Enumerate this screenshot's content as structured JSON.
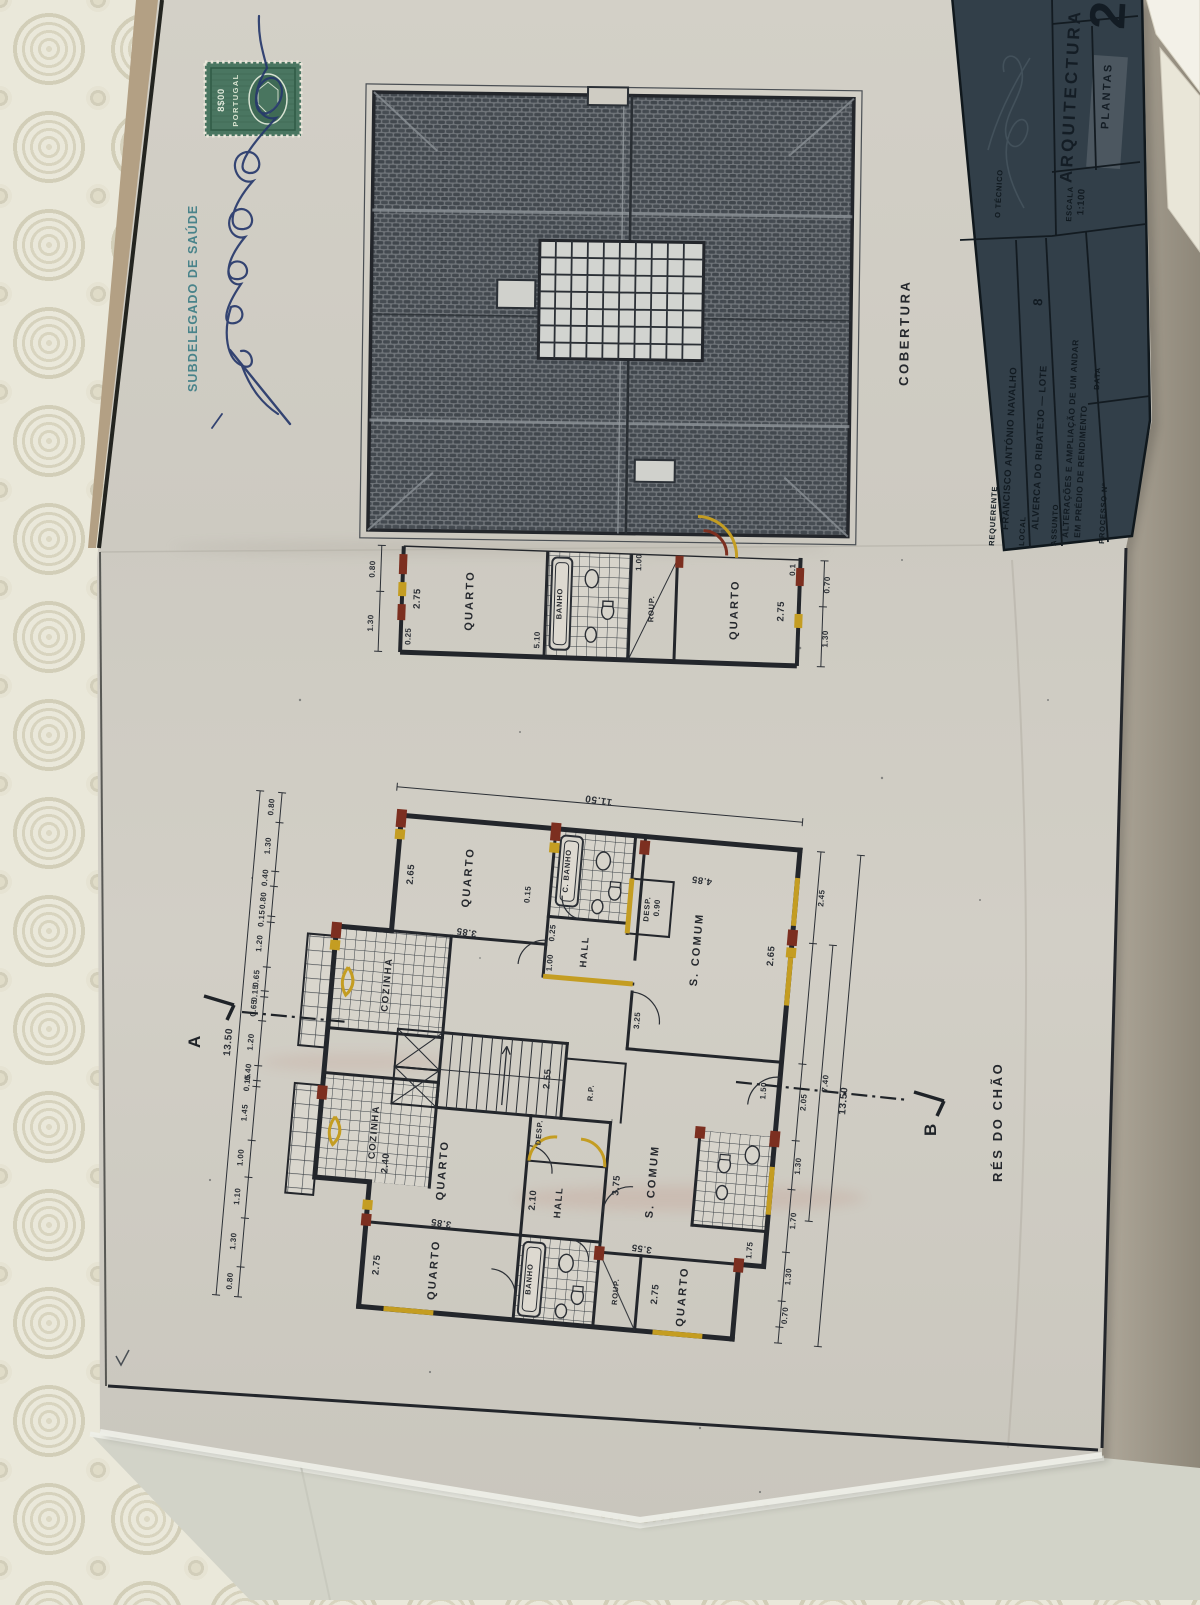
{
  "colors": {
    "drawing_ink": "#24272c",
    "alteration_yellow": "#c49d22",
    "alteration_red": "#7c2f20",
    "stamp_green": "#4a7661",
    "authority_teal": "#3e7d86",
    "signature_ink": "#26386b",
    "titleblock_bg": "#323f49"
  },
  "stamp_area": {
    "authority_text": "SUBDELEGADO DE SAÚDE",
    "stamp_value": "8$00",
    "stamp_country": "PORTUGAL"
  },
  "titleblock": {
    "sheet_number": "2",
    "discipline": "ARQUITECTURA",
    "content_type": "PLANTAS",
    "tecnico_label": "O TÉCNICO",
    "escala_label": "ESCALA",
    "escala_value": "1:100",
    "requerente_label": "REQUERENTE",
    "requerente_value": "FRANCISCO ANTÓNIO NAVALHO",
    "local_label": "LOCAL",
    "local_value": "ALVERCA DO RIBATEJO — LOTE",
    "lote_number": "8",
    "assunto_label": "ASSUNTO",
    "assunto_line1": "ALTERAÇÕES E AMPLIAÇÃO DE UM ANDAR",
    "assunto_line2": "EM PRÉDIO DE RENDIMENTO",
    "processo_label": "PROCESSO Nº",
    "data_label": "DATA"
  },
  "roof_plan": {
    "title": "COBERTURA"
  },
  "upper_plan": {
    "room_left": "QUARTO",
    "room_bath": "BANHO",
    "room_closet": "ROUP.",
    "room_right": "QUARTO",
    "dims": {
      "left_width": "2.75",
      "left_wall": "0.25",
      "bath_width": "1.00",
      "strip": "5.10",
      "right_width": "2.75",
      "right_wall": "0.1",
      "side_a": "0.80",
      "side_b": "1.30",
      "side_c": "0.70",
      "side_d": "1.30"
    }
  },
  "ground_plan": {
    "title": "RÉS DO CHÃO",
    "section_a": "A",
    "section_b": "B",
    "total_width": "11.50",
    "total_height": "13.50",
    "left_chain": [
      "0.80",
      "1.30",
      "0.40",
      "0.80",
      "0.15",
      "1.20",
      "0.65",
      "0.15",
      "0.65",
      "1.20",
      "0.40",
      "0.15",
      "1.45",
      "1.00",
      "1.10",
      "1.30",
      "0.80"
    ],
    "right_chain": [
      "2.45",
      "7.40",
      "2.05",
      "1.30",
      "1.70",
      "1.30",
      "0.70"
    ],
    "rooms": {
      "quarto": "QUARTO",
      "scomum": "S. COMUM",
      "hall": "HALL",
      "cozinha": "COZINHA",
      "banho": "BANHO",
      "cbanho": "C. BANHO",
      "desp": "DESP.",
      "roup": "ROUP.",
      "rp": "R.P."
    },
    "dims": {
      "quarto_t_w": "3.85",
      "quarto_t_h": "2.65",
      "scomum_t_w": "4.85",
      "scomum_t_h": "2.65",
      "stair_w": "2.55",
      "stair_l": "3.25",
      "hall_w": "1.00",
      "wall": "0.15",
      "pier": "0.25",
      "hall_b": "2.10",
      "quarto_m_w": "3.85",
      "quarto_m_h": "2.40",
      "quarto_b_h": "2.75",
      "scomum_b_w": "3.55",
      "scomum_b_h": "3.75",
      "entry": "1.50",
      "misc_a": "1.75",
      "misc_b": "0.90"
    }
  }
}
